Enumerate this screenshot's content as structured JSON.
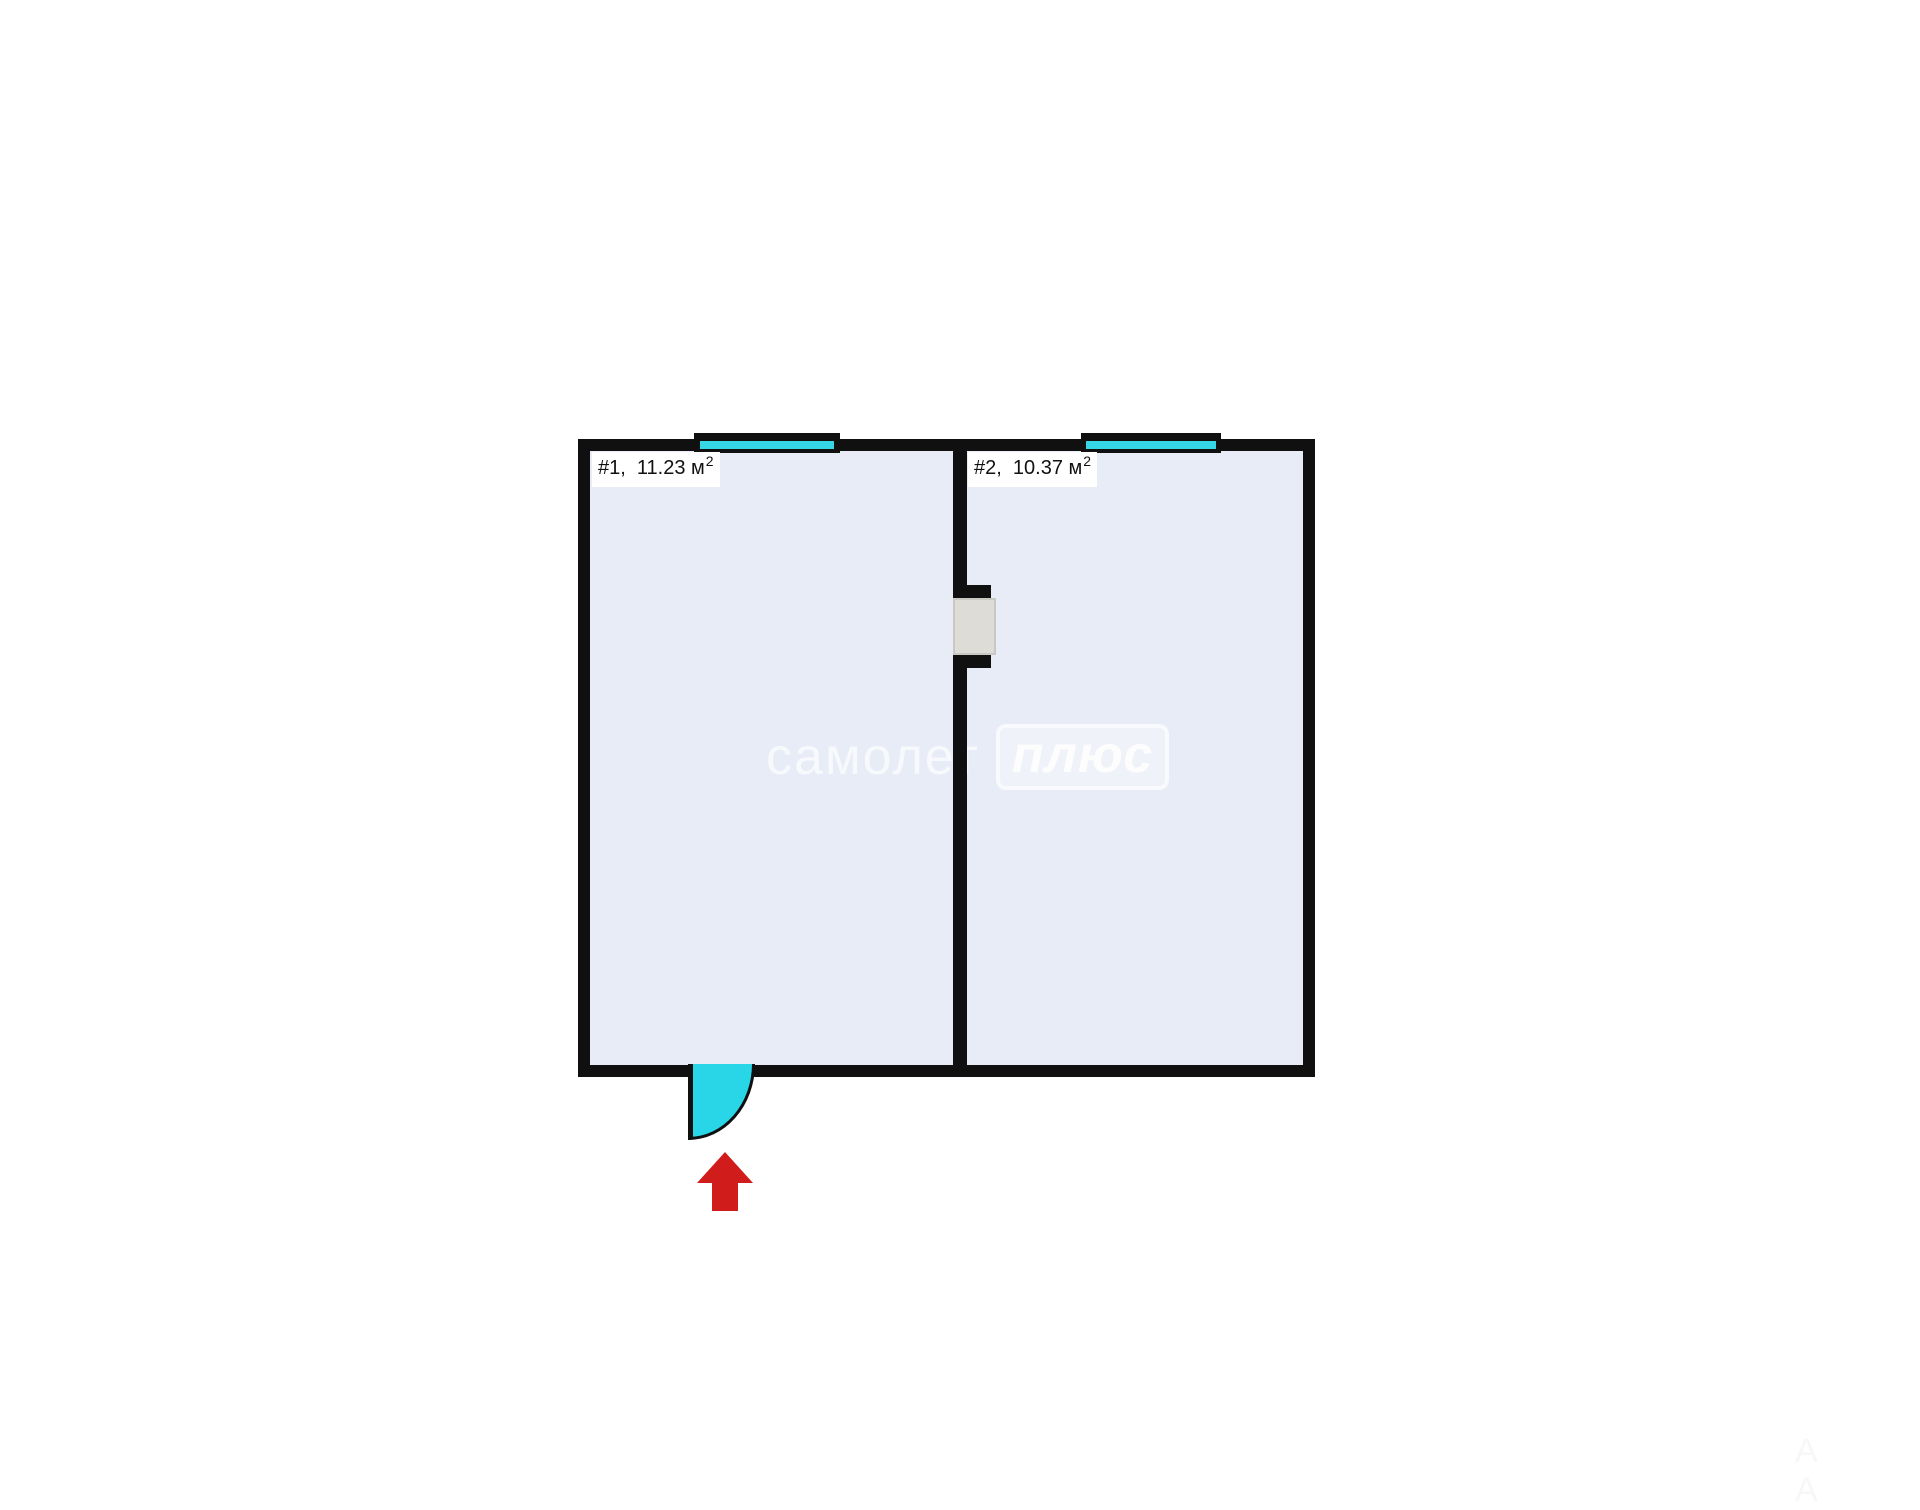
{
  "watermark": {
    "brand": "самолет",
    "badge": "плюс"
  },
  "rooms": [
    {
      "label": "#1,  11.23 м",
      "sup": "2"
    },
    {
      "label": "#2,  10.37 м",
      "sup": "2"
    }
  ],
  "artifacts": {
    "corner_marks": "A A"
  },
  "colors": {
    "background": "#ffffff",
    "wall": "#101010",
    "room_fill": "#e8ecf7",
    "window": "#35d7e6",
    "door": "#29d6e8",
    "passage_panel": "#dddcd7",
    "arrow": "#d11c1c",
    "label_bg": "#ffffff"
  }
}
